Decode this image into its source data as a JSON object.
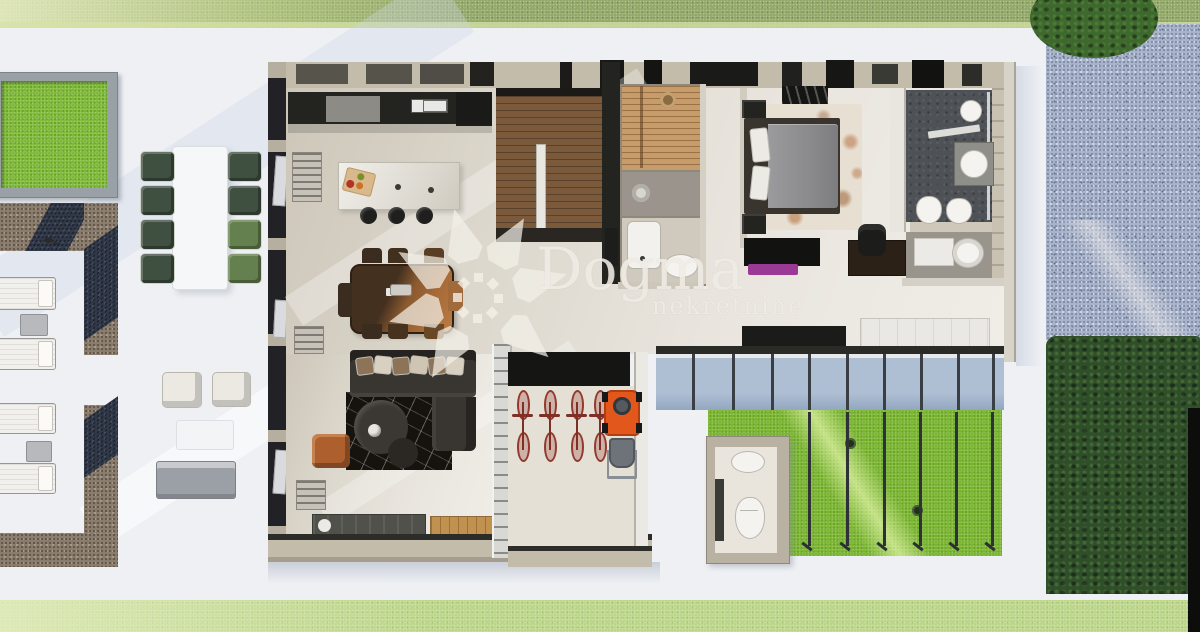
{
  "watermark": {
    "brand": "Dogma",
    "tagline": "nekretnine"
  },
  "palette": {
    "terrace": "#eef0f4",
    "grass_top": "#93a96a",
    "grass_bottom": "#bcd68a",
    "lawn": "#7cb733",
    "hedge": "#2f4f2b",
    "gravel_blue": "#a9b4cb",
    "gravel_brown": "#8b7d6e",
    "floor": "#e2ddd3",
    "stair_wood": "#7b5a3b",
    "sauna_wood": "#c69c6a",
    "sofa": "#393530",
    "dining_wood": "#a76a38",
    "mower_orange": "#e2571c",
    "bike_red": "#93392e",
    "bench_purple": "#9b3a95",
    "slate_bath": "#4e5257",
    "watermark_ink": "#f3f0e9"
  },
  "floor_plan": {
    "type": "villa-ground-floor-3d-render",
    "rooms": [
      {
        "name": "kitchen-dining-living",
        "features": [
          "kitchen counter",
          "island with 3 bar stools",
          "dining table for 8",
          "L-shaped sofa",
          "black marble rug",
          "round coffee tables",
          "orange pouf",
          "sideboard"
        ]
      },
      {
        "name": "staircase",
        "features": [
          "wooden treads",
          "handrail"
        ]
      },
      {
        "name": "sauna",
        "features": [
          "wood benches",
          "bucket"
        ]
      },
      {
        "name": "shower-room",
        "features": [
          "walk-in shower"
        ]
      },
      {
        "name": "guest-wc",
        "features": [
          "toilet",
          "shower tray"
        ]
      },
      {
        "name": "master-bedroom",
        "features": [
          "double bed",
          "nightstands",
          "clothes rail",
          "tv console",
          "purple bench",
          "desk with office chair",
          "wardrobe"
        ]
      },
      {
        "name": "ensuite-bathroom",
        "features": [
          "rain shower",
          "vanity basin",
          "toilet",
          "bidet",
          "round tub"
        ]
      },
      {
        "name": "storage-room",
        "features": [
          "4 bicycles",
          "lawn mower"
        ]
      },
      {
        "name": "outdoor-wc",
        "features": [
          "toilet",
          "washbasin"
        ]
      },
      {
        "name": "terrace",
        "features": [
          "4 sun loungers",
          "outdoor dining table with 8 green chairs",
          "2 cream armchairs",
          "grey sofa",
          "gravel paths",
          "grass planter"
        ]
      },
      {
        "name": "lawn-pergola",
        "features": [
          "6 pergola beams",
          "2 ground spotlights"
        ]
      }
    ]
  }
}
